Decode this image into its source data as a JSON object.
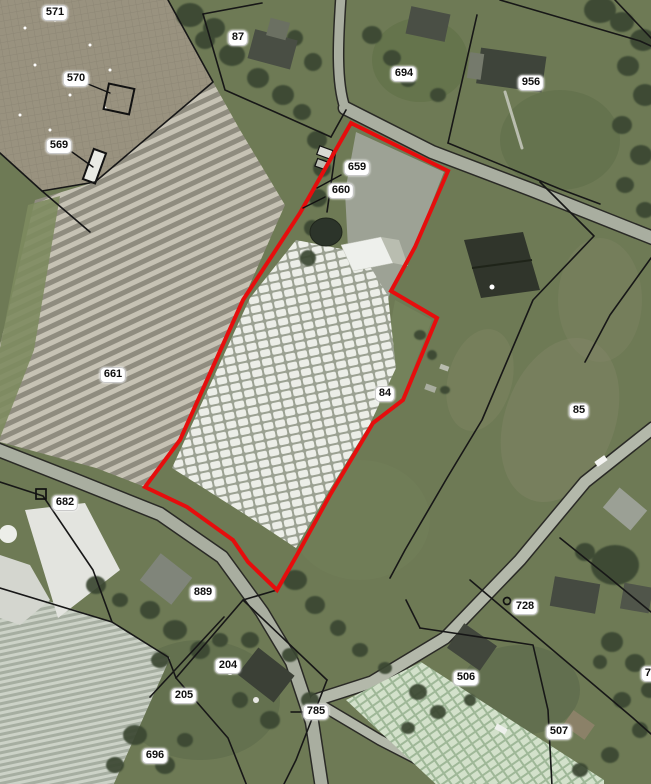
{
  "map": {
    "type": "aerial-cadastral-parcel-map",
    "colors": {
      "highlight": "#e60d0d",
      "boundary": "#171717",
      "label_bg": "#ffffff",
      "label_text": "#101010"
    },
    "highlighted_parcel": {
      "parcel_number": "84",
      "points": "351,123 448,171 415,247 391,291 437,318 403,400 373,423 330,495 297,555 277,590 248,562 233,540 187,507 145,487 180,440 243,300 300,213"
    },
    "labels": [
      {
        "text": "571",
        "x": 55,
        "y": 13
      },
      {
        "text": "570",
        "x": 76,
        "y": 79
      },
      {
        "text": "569",
        "x": 59,
        "y": 146
      },
      {
        "text": "87",
        "x": 238,
        "y": 38
      },
      {
        "text": "694",
        "x": 404,
        "y": 74
      },
      {
        "text": "956",
        "x": 531,
        "y": 83
      },
      {
        "text": "659",
        "x": 357,
        "y": 168
      },
      {
        "text": "660",
        "x": 341,
        "y": 191
      },
      {
        "text": "661",
        "x": 113,
        "y": 375
      },
      {
        "text": "84",
        "x": 385,
        "y": 394
      },
      {
        "text": "85",
        "x": 579,
        "y": 411
      },
      {
        "text": "682",
        "x": 65,
        "y": 503
      },
      {
        "text": "889",
        "x": 203,
        "y": 593
      },
      {
        "text": "204",
        "x": 228,
        "y": 666
      },
      {
        "text": "205",
        "x": 184,
        "y": 696
      },
      {
        "text": "696",
        "x": 155,
        "y": 756
      },
      {
        "text": "785",
        "x": 316,
        "y": 712
      },
      {
        "text": "728",
        "x": 525,
        "y": 607
      },
      {
        "text": "506",
        "x": 466,
        "y": 678
      },
      {
        "text": "507",
        "x": 559,
        "y": 732
      },
      {
        "text": "72",
        "x": 651,
        "y": 674
      }
    ],
    "leader_lines": [
      {
        "points": "88,84 110,93"
      },
      {
        "points": "72,152 93,167"
      },
      {
        "points": "341,175 317,188"
      },
      {
        "points": "325,197 303,208"
      },
      {
        "points": "291,712 303,712"
      }
    ],
    "boundary_lines": [
      {
        "points": "168,0 213,82 95,182 42,191 0,153"
      },
      {
        "points": "42,191 90,232"
      },
      {
        "points": "203,14 225,90 275,112 331,137"
      },
      {
        "points": "203,14 262,3"
      },
      {
        "points": "331,137 346,110"
      },
      {
        "points": "500,0 640,41 651,46"
      },
      {
        "points": "477,15 448,143"
      },
      {
        "points": "448,143 560,189 600,204"
      },
      {
        "points": "540,182 594,236 533,300 482,420 447,478 405,550 390,578"
      },
      {
        "points": "651,258 610,315 585,362"
      },
      {
        "points": "0,482 43,496 93,570 112,622 168,657 176,678"
      },
      {
        "points": "277,590 243,600 176,678"
      },
      {
        "points": "243,600 327,680"
      },
      {
        "points": "327,680 296,760 283,786"
      },
      {
        "points": "176,678 228,738 247,786"
      },
      {
        "points": "224,617 150,697"
      },
      {
        "points": "470,580 633,718 651,734"
      },
      {
        "points": "420,628 533,645 548,710 552,786"
      },
      {
        "points": "420,628 406,600"
      },
      {
        "points": "0,588 112,622"
      },
      {
        "points": "336,148 327,212"
      },
      {
        "points": "615,0 651,38"
      },
      {
        "points": "560,538 606,575 651,612"
      }
    ],
    "markers": [
      {
        "shape": "circle",
        "x": 507,
        "y": 601
      },
      {
        "shape": "square",
        "x": 41,
        "y": 494
      }
    ]
  }
}
